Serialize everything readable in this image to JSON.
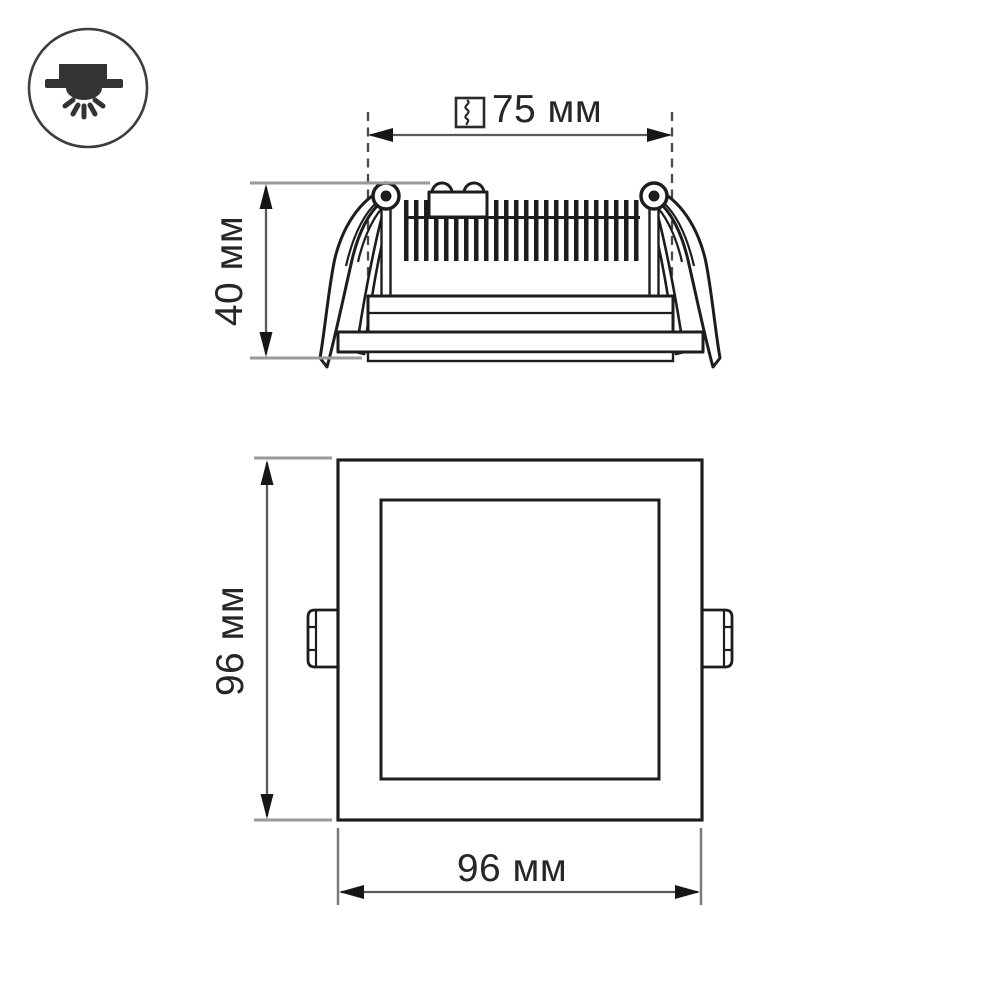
{
  "page": {
    "background": "#ffffff"
  },
  "type_icon": {
    "name": "recessed-downlight-icon"
  },
  "side_view": {
    "cutout_dimension": {
      "icon": "cutout-hole-icon",
      "label": "75 мм"
    },
    "height_dimension": {
      "label": "40 мм"
    }
  },
  "front_view": {
    "height_dimension": {
      "label": "96 мм"
    },
    "width_dimension": {
      "label": "96 мм"
    }
  },
  "colors": {
    "line": "#1d1d1d",
    "dimension_line": "#5a5a5a",
    "extension_line": "#9a9a9a",
    "text": "#262626",
    "icon_fill": "#333333"
  }
}
